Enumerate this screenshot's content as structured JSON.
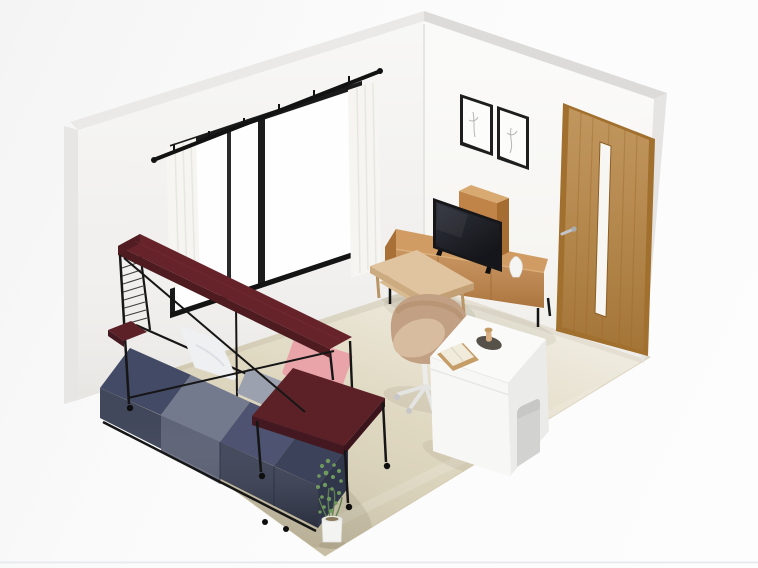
{
  "view": {
    "type": "3d-room-render",
    "description": "Isometric 3D rendering of a furnished studio room seen from above-front, no text or UI chrome visible",
    "width_px": 758,
    "height_px": 568
  },
  "scene": {
    "room": {
      "left_wall": "white wall with black-framed sliding window, sheer curtains and black curtain rail",
      "right_wall": "white wall with wooden door and two framed sketches",
      "floor": "beige wood floor, lighter near walls, darker toward front corner"
    },
    "objects": [
      {
        "id": "window",
        "label": "sliding window with black frame"
      },
      {
        "id": "curtains",
        "label": "white sheer curtains on black rail"
      },
      {
        "id": "door",
        "label": "oak door with vertical glass slit and lever handle"
      },
      {
        "id": "wall-art",
        "label": "two thin black frames with faint sketches"
      },
      {
        "id": "tv-board",
        "label": "wooden TV board with black legs"
      },
      {
        "id": "hutch",
        "label": "tall wooden shelf unit behind TV"
      },
      {
        "id": "tv",
        "label": "black flat-screen TV on feet"
      },
      {
        "id": "vase",
        "label": "small white vase"
      },
      {
        "id": "coffee-table",
        "label": "light wood coffee table with lower shelf"
      },
      {
        "id": "lounge-chair",
        "label": "beige tub swivel chair on white caster base"
      },
      {
        "id": "desk",
        "label": "white desk with open book, tray, oval mat and figurine"
      },
      {
        "id": "loft-bed",
        "label": "black pipe bed frame with dark red overhead shelf, side tray and casters"
      },
      {
        "id": "mattress",
        "label": "navy and gray sectioned mattress"
      },
      {
        "id": "pillows",
        "label": "white pillow and gray pillow"
      },
      {
        "id": "cushion",
        "label": "pink cushion at bed foot"
      },
      {
        "id": "side-table",
        "label": "dark red side table over bed foot"
      },
      {
        "id": "plant",
        "label": "green plant in white cylindrical pot"
      }
    ]
  },
  "colors": {
    "background": "#fbfbfb",
    "page_border": "#e7e9ed",
    "floor": "#ddd5bc",
    "wall_left": "#f1f0ee",
    "wall_right": "#f6f5f2",
    "wall_side_left": "#e7e6e4",
    "wall_side_right": "#e5e4e2",
    "wall_bevel_left": "#eae9e7",
    "wall_bevel_right": "#dcdbd9",
    "window_frame": "#1c1c1c",
    "window_glass": "#fefefe",
    "curtain": "#f6f5f1",
    "curtain_rod": "#121212",
    "door_wood": "#b5823f",
    "door_trim": "#a1702e",
    "door_glass": "#f7f6f2",
    "door_handle": "#c3c6c8",
    "art_frame": "#1e1e1e",
    "art_paper": "#fcfcfb",
    "tv_black": "#17171a",
    "wood_top": "#d09c63",
    "wood_front": "#c08448",
    "wood_dark": "#a66d33",
    "hutch_top": "#d8aa71",
    "table_top": "#e0c49f",
    "table_side": "#ccab80",
    "table_leg": "#b99465",
    "desk_front": "#f7f7f6",
    "desk_side": "#ebebe9",
    "desk_top": "#fafaf9",
    "chair_shell": "#c2a083",
    "chair_seat": "#d8bca0",
    "chair_base": "#e4e4e3",
    "metal_black": "#161616",
    "shelf_top": "#67232a",
    "shelf_front": "#4e1b21",
    "shelf_maroon": "#5c2127",
    "mattress_navy": "#434a66",
    "mattress_gray": "#747a8d",
    "mattress_navy2": "#4d5370",
    "mattress_navy3": "#3c4259",
    "pillow_white": "#eef0f2",
    "pillow_gray": "#9ba1af",
    "cushion_pink": "#e9a4a9",
    "vase_white": "#f5f5f3",
    "plant_green": "#6f9a5d",
    "plant_stem": "#5d7f4e",
    "pot_white": "#f3f3f1"
  }
}
